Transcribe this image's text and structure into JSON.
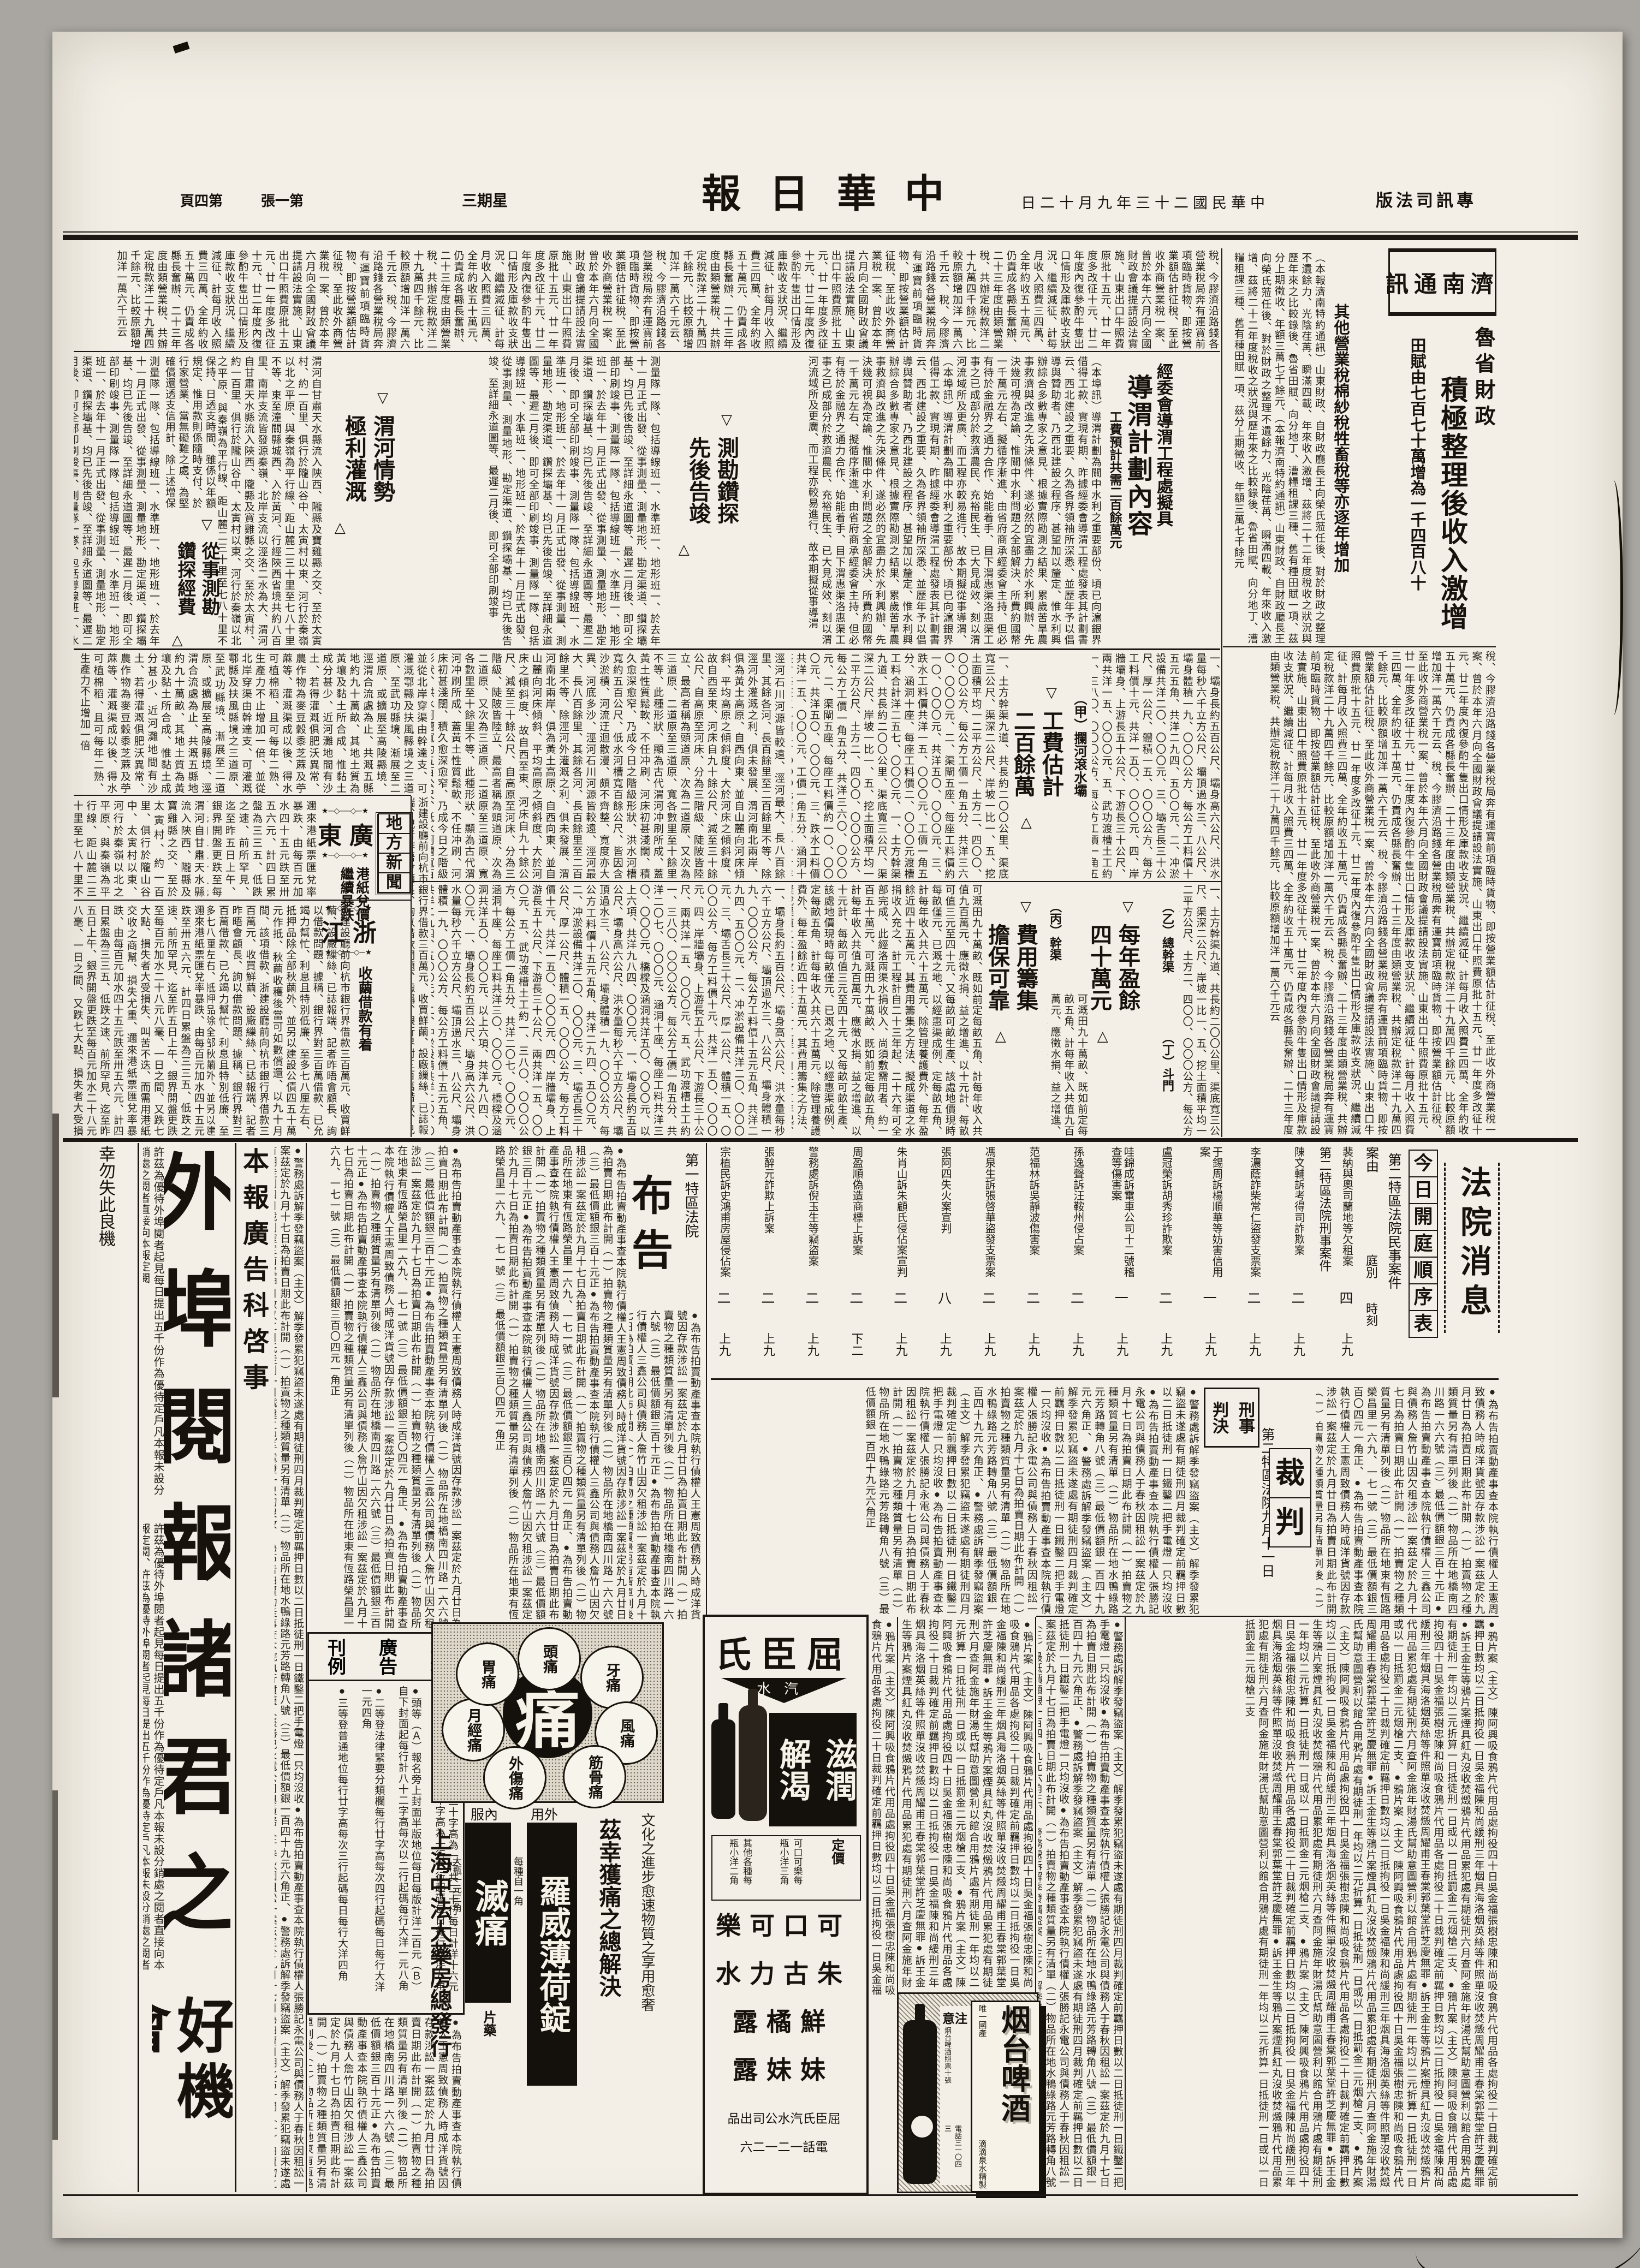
{
  "masthead": {
    "edition": "專訊司法版",
    "date": "中華民國二十三年九月十二日",
    "title": "中華日報",
    "weekday": "星期三",
    "sheet": "第一張",
    "page": "第四頁"
  },
  "jinan": {
    "box": "濟南通訊",
    "kicker": "魯省財政",
    "headline": "積極整理後收入激增",
    "deck1": "田賦由七百七十萬增為一千四百八十萬",
    "deck2": "其他營業稅棉紗稅牲畜稅等亦逐年增加"
  },
  "daowei": {
    "kicker": "經委會導渭工程處擬具",
    "headline": "導渭計劃內容",
    "deck": "工費預計共需二百餘萬元",
    "sub_survey": "測勘鑽探先後告竣",
    "sub_weihe": "渭河情勢極利灌溉",
    "sub_funds": "從事測勘鑽探經費",
    "sub_cost": "工費估計二百餘萬",
    "sub_surplus": "每年盈餘四十萬元",
    "sub_financing": "費用籌集擔保可靠",
    "sec_a": "（甲）攔河滾水壩",
    "sec_b": "（乙）總幹渠",
    "sec_c": "（丙）幹渠",
    "sec_d": "（丁）斗門",
    "marker_top": "▽",
    "marker_bottom": "△"
  },
  "local": {
    "box": "地方新聞",
    "guangdong": "廣東",
    "gd_sub": "港紙兌價繼續暴跌",
    "zhejiang": "浙江",
    "zj_sub": "收繭借款有着",
    "stars": "★─◇──◇─★"
  },
  "court": {
    "news": "法院消息",
    "schedule": "今日開庭順序表",
    "civil_label": "第二特區法院民事案件",
    "criminal_label": "第二特區法院刑事案件",
    "col_case": "案由",
    "col_court": "庭別",
    "col_time": "時刻",
    "civil_rows": [
      {
        "name": "裴納與奧司蘭地等欠租案",
        "court": "四",
        "time": "上九"
      }
    ],
    "criminal_rows": [
      {
        "name": "陳文輔訴考得司詐欺案",
        "court": "二",
        "time": "上九"
      },
      {
        "name": "李濃蔭詐柴常仁盜發支票案",
        "court": "二",
        "time": "上九"
      },
      {
        "name": "于錫周訴楊順華等妨害信用案",
        "court": "一",
        "time": "上九"
      },
      {
        "name": "盧冠榮訴胡秀珍詐欺案",
        "court": "二",
        "time": "上九"
      },
      {
        "name": "哇錦成訴電車公司十二號稽查等傷害案",
        "court": "一",
        "time": "上九"
      },
      {
        "name": "孫逸聲訴汪鞍州侵占案",
        "court": "二",
        "time": "上九"
      },
      {
        "name": "范福林訴吳靜波傷害案",
        "court": "二",
        "time": "上九"
      },
      {
        "name": "馮泉生訴張啓華盜發支票案",
        "court": "二",
        "time": "上九"
      },
      {
        "name": "張阿四失火案宣判",
        "court": "八",
        "time": "上九"
      },
      {
        "name": "朱肖山訴朱顧氏侵佔案宣判",
        "court": "二",
        "time": "上九"
      },
      {
        "name": "周盈順偽造商標上訴案",
        "court": "二",
        "time": "下二"
      },
      {
        "name": "警務處訴倪玉生等竊盜案",
        "court": "二",
        "time": "上九"
      },
      {
        "name": "張醉元詐欺上訴案",
        "court": "二",
        "time": "上九"
      },
      {
        "name": "宗植民訴史鴻甫房屋侵佔案",
        "court": "二",
        "time": "上九"
      }
    ],
    "verdict_tag1": "刑事",
    "verdict_tag2": "判決",
    "verdict": "裁判",
    "verdict_date": "第二特區法院九月十一日",
    "notice_label": "第一特區法院",
    "notice": "布告"
  },
  "ads": {
    "subscribe": {
      "headline_top": "外埠閱報諸君之",
      "headline_end": "好機會",
      "intro": "許茲為優待外埠閱者起見每日提出五千份作為優待定戶凡本報未設分銷處之閱者直接向本報定閱",
      "note": "幸勿失此良機"
    },
    "dept": "本報廣告科啓事",
    "rates": {
      "w1": "本報",
      "w2": "廣告",
      "w3": "刊例",
      "items": [
        "●特等（Ａ）登報名下二十字高為一行共二十行每日計洋十六元（Ｂ）登新聞欄中以四十字高為一行三行起碼每日每行大洋九角",
        "●頭等（Ａ）報名旁上封面半版地位每日每版計洋二百元（Ｂ）自下封面起每行計八十二字高每次以二行起碼每行大洋一元八角",
        "●二等登法律緊要分類欄每行廿字高每次四行起碼每日每行大洋一元四角",
        "●三等登普通地位每行廿字高每次三行起碼每日每行大洋四角"
      ]
    },
    "pain": {
      "center": "痛",
      "circles": [
        "頭痛",
        "牙痛",
        "風痛",
        "筋骨痛",
        "外傷痛",
        "月經痛",
        "胃痛"
      ],
      "use1": "外用",
      "med1": "羅威薄荷錠",
      "price1": "每種自一角",
      "use2": "內服",
      "med2": "滅痛",
      "sub2": "片藥",
      "price2": "大瓶一元三角",
      "slogan": "茲幸獲痛之總解決",
      "note": "文化之進步愈速物質之享用愈奢",
      "maker": "上海中法大藥房總發行"
    },
    "watsons": {
      "brand": "屈臣氏",
      "type": "汽水",
      "slogan1": "滋潤",
      "slogan2": "解渴",
      "price_t": "定價",
      "price1": "可口可樂每瓶小洋三角",
      "price2": "其他各種每瓶小洋二角",
      "products": [
        "可口可樂",
        "朱古力水",
        "鮮橘露",
        "妹妹露"
      ],
      "maker": "屈臣氏汽水公司出品",
      "phone": "電話一二一二六"
    },
    "beer": {
      "name": "烟台啤酒",
      "tag1": "唯一國產",
      "tag2": "滴滴泉水精製",
      "warn": "注意",
      "note1": "烟台啤酒照票十張",
      "note2": "可換上等毛巾一條",
      "note3": "各大公司及洋雜貨店均可換",
      "phone": "電話三一〇四三"
    }
  },
  "filler": {
    "a": "（本報濟南特約通訊）山東財政、自財政廳長王向榮氏蒞任後、對於財政之整理不遺餘力、光陰荏苒、瞬滿四載、年來收入激增、茲將二十二年度稅收之狀況與歷年來之比較錄後、魯省田賦、向分地丁、漕糧租課三種、舊有種田賦一項、茲分上期徵收、年額三萬七千餘元",
    "b": "稅、今膠濟沿路錢各營業稅局奔有運寶前項臨時貨物、即按營業額估計征稅、至此收外商營業稅一案、曾於本年六月向全國財政會議提請設法實施、山東出口牛照費原批十五元、廿一年度多改征十元、廿二年度內復參酌牛隻出口情形及庫款收支狀況、繼續減征、計每月收入照費三四萬、全年約收五十萬元、仍責成各縣長奮辦、二十三年度由類營業稅、共辦定稅款洋二十九萬四千餘元、比較原額增加洋一萬六千元云",
    "c": "（本埠訊）導渭計劃為關中水利之重要部份、頃已向滬銀界借得工款、實現有期、昨據經委會導渭工程處發表其計劃書云、西北建設之重要、久為各界領袖所深悉、並歷年予以倡導與贊助者、乃西北建設之程序、甚望加以釐定、惟水利興辦綜合多數專家之意見、根據實際勘測之結果、累歲苦旱農事救濟與改進之先決條件、遂必然的宜盡力於水利興辦、先決幾可視為定論、惟關中水利問題之全部解決、所費約國幣一千萬元左右、擬循序漸進、由省府商承經委會主持、但必有待於金融界之通力合作、始能着手、目下渭惠渠洛惠渠工事之已成部分於救濟農民、充裕民生、已大見成效、刻以渭河流域所及更廣、而工程亦較易進行、故本期擬從事導渭",
    "d": "涇河石川河源皆較遠、涇河最大、長八百餘里、其餘各河、長百餘里至二百餘里不等、除涇河外灌溉之利、俱未發展、渭河南北兩岸、俱為黃土高原、自西向東、並自山麓向河床傾斜、平均高原之傾斜度、大於河床之傾斜度、故自西至東、河床自九十餘公尺、減至三十餘公尺、自高原至河床、分為三階級、陡陂皆陸立、最高者稱為頭道原、次為二道原、又次為三道原、二道原至三道原、寬各數里至十餘里不等、此種形狀、顯為古代渭河冲刷所成、蓋黃土性質鬆軟、不任冲刷、河床初甚淺闊、積久愈深愈窄、乃成今日之階級形狀、洪水河槽寬約五百公尺、低水河槽寬百餘公尺、皆因含沙淤積、河流迂迴散漫、頗不齊整、寬度亦大異、河底多沙",
    "e": "一、壩身長約五百公尺、壩身高六公尺、洪水量每秒六千立方公尺、壩頂過水三、八公尺、壩身體積一九、〇〇〇公方、每公方工料價十五元五角、共洋二九四、五〇〇元、二、冲淤設備共洋二〇、〇〇〇元、三、壩舌長三十公尺、厚一公尺、體積一五、〇〇〇公方、每方工料價十元、共洋一五〇、〇〇〇元、四、岸牆壩身、上游長五十公尺、下游長三十公尺、兩共洋一五、〇〇〇元、五、武功渡槽土工約一、三八〇、〇〇〇公方、每公方工價一角五分、共洋二〇七、〇〇〇元、涵洞十座、每座工料共洋三〇、〇〇〇元、橋樑及涵洞共洋五〇、〇〇〇元、以上六項、共洋九八四、〇〇〇元",
    "f": "一、土方幹渠九道、共長約二〇〇公里、渠底寬三公尺、渠深二公尺、岸坡一比一、五、挖土面積平均一二平方公尺、土方二、四〇〇、〇〇〇公方、每公方工價一角五分、共洋三六〇、〇〇〇元、二、渠閘五座、每座工料價約一〇、〇〇〇元、共洋五〇、〇〇〇元、三、跌水工料價共洋一五、〇〇〇元、工價一角五分、涵洞十座、每座工料價二、〇〇〇元渡槽工料合計洋二五七、〇〇〇元",
    "g": "可溉田九十萬畝、既如前定每畝五角、計每年收入共值九百萬元、應徵水捐、益之增進、以十元計、每畝可值三元至四十元、又每畝可畝生產、該處地價現時每畝僅元、已溉之地、以經惠渠成例、定每畝五角、計每年收入共六十五萬元、除管理養護費外、每年盈餘近四十五萬元、其費用籌集之方法、擬成渠道之水捐收入充之、計工程計自二十三年起、二十六年可全部完成、此經洛兩渠水捐收入、尚須敷需用者、約一百五十萬元",
    "h": "●為布告拍賣動產事查本院執行債權人王憲周致債務人時成洋貨號因存款涉訟一案茲定於九月廿日為拍賣日期此布計開（一）拍賣物之種類質量另有清單列後（二）物品所在地橋南四川路一六六號（三）最低價額銀三百十元正●為布告拍賣動產事查本院執行債權人三鑫公司與債務人詹竹山因欠租涉訟一案茲定於九月十七日為拍賣日期此布計開（一）拍賣物之種類質量另有清單列後（二）物品所在地東有恆路榮昌里一六九、一七一號（三）最低價額銀三百〇四元一角正",
    "i": "●警務處訴解季發竊盜案（主文）解季發累犯竊盜未遂處有期徒刑四月裁判確定前羈押日數以二日抵徒刑一日鐵鑿二把手電燈一只均沒收●為布告拍賣動產事查本院執行債權人張勝記永電公司與債務人于春秋因租訟一案茲定於九月十七日為拍賣日期此布計開（一）拍賣物之種類質量另有清單（二）物品所在地水鴨綠路元芳路轉角八號（三）最低價額銀一百四十九元六角正",
    "j": "●鴉片案（主文）陳阿興吸食鴉片代用品處拘役四十日吳金福張樹忠陳和尚吸食鴉片代用品各處拘役二十日裁判確定前羈押日數均以二日抵拘役一日吳金福陳和尚緩刑三年烟具海洛烟英絲等件照單沒收焚燬周耀甫王春棠郭葉堂許芝慶無罪●訴王金生等鴉片案煙具紅丸沒收焚燬鴉片代用品累犯處有期徒刑六月查阿金施年財湯氏幫助意圖營利以館合用鴉片處有期徒刑一年均以二元折算一日抵徒刑一日或以一日抵罰金二元烟槍二支",
    "k": "邇來港紙票匯兌率暴跌、由每百元加水四十五元跌至卅五六元、計四日累盤為三三五、低跌之速、前所罕見、迄至昨五日上午、銀界開盤更跌至每百元加水二十八元八毫、一日之間、又跌七大點、損失者大受損失、叫苦不迭、而需用港紙交收之商幫、損失尤重",
    "l": "浙建設廳前向杭市銀行界借款三百萬元、收買鮮繭、設廠繅絲、已誌報端、記者昨晤會顧長、詢以借款問題、據稱、銀行界對三百萬借款、已允竭力幫忙、利息且特別低廉、至多七八厘左右、抵押品除全部秋繭外、並另以建設公債四五十萬元作抵、秋繭收穫後當可如數償還、以九十月間、該項借款",
    "m": "測量隊一隊、包括導線班一、水準班一、地形班一、於去年十一月正式出發、從事測量、測量地形、勘定渠道、鑽探壩基、均已先後告竣、至詳細永道圖等、最遲二月後、即可全部印刷竣事",
    "o": "渭河自甘肅天水縣流入陝西、隴縣及寶雞縣之交、至於太寅村、約一百里、俱行於隴山谷中、太寅村以東、河行於秦嶺以北之平原、與秦嶺為平行線、距山麓二三十里至七八十里不等、東至潼關縣城西、入於黃河、行經陝西省境共約八百里、南岸支流皆發源秦嶺、北岸支流以涇洛二水為大",
    "p": "並從北岸穿渠由幹達支、可灌溉鄠縣及扶風縣境之三道原、至武功縣境、漸展至二道原、或擴展至高陵縣境、涇渭合流處為止、共溉五縣地約九十萬畝、其地土質為黃壤及黏土所合成、惟黏土成分甚少、近河灘地間有沙土、若得灌溉俱肥沃異常、農作物為麥豆穀黍芝蔴及苧蔴等、灌溉渠成以後、得水可植棉稻、且可每年二熟、生產力不止增加一倍",
    "q": "保持、日透支時間、雖係以年額規定、惟用款則係隨時支付、於行家營業、當無礙難之處、為堅確償還透支信用計、除上述增保稅收外、更附以三項原則、亟希鑒及、一、所有水捐保管監督辦法、省府應與經委會及投資方面、共同組織一委員會任之、其條例可附存透支成立之合同內、一、為求工程之完成"
  }
}
